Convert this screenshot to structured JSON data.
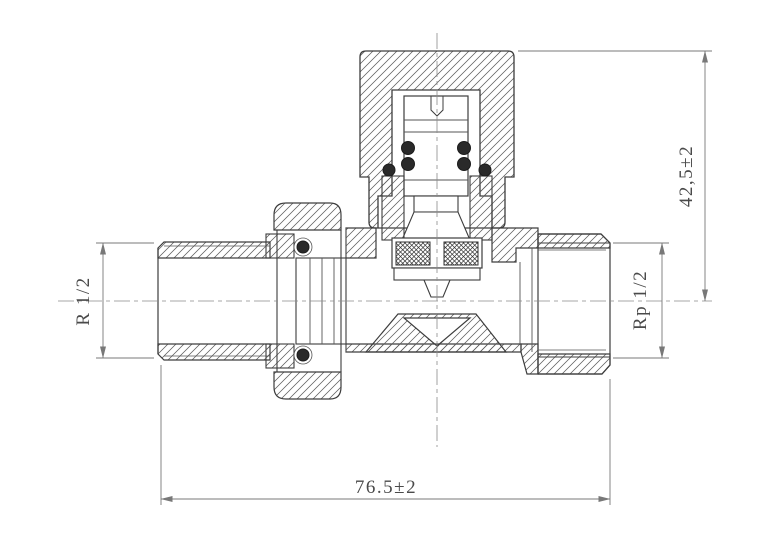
{
  "drawing": {
    "dimensions": {
      "overall_height": "42,5±2",
      "overall_length": "76.5±2",
      "thread_left": "R 1/2",
      "thread_right": "Rp 1/2"
    },
    "colors": {
      "outline": "#3d3d3d",
      "hatch": "#555555",
      "dimension_line": "#787878",
      "label_text": "#4a4a4a",
      "background": "#ffffff"
    }
  }
}
